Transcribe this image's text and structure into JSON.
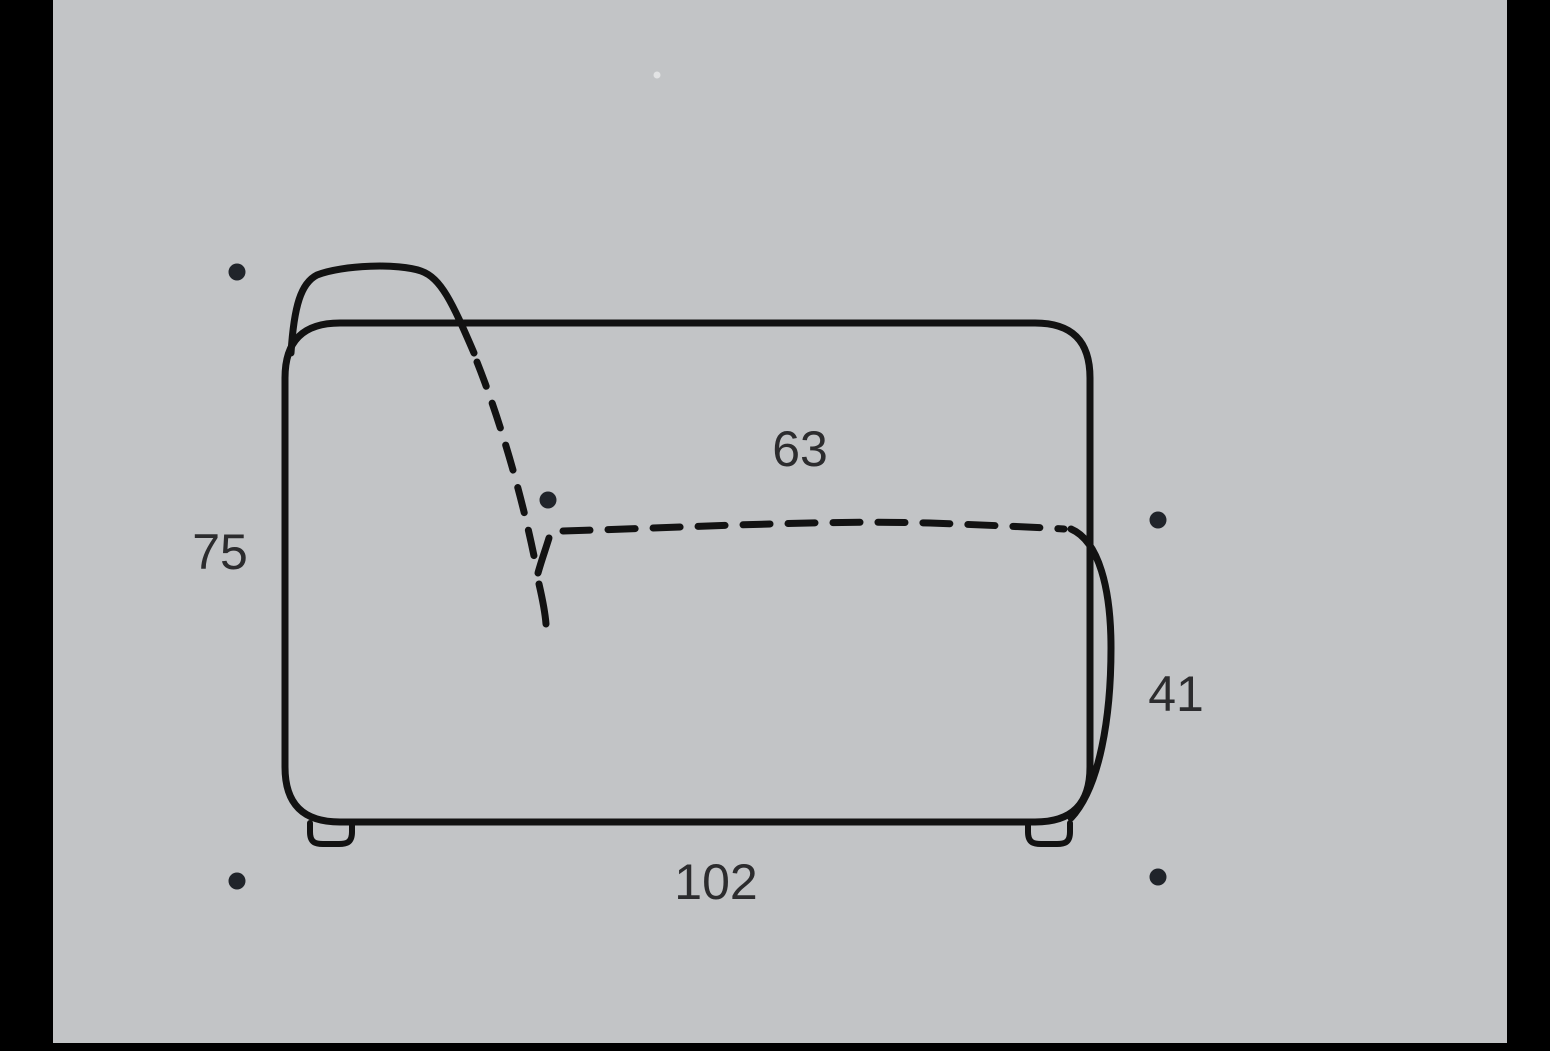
{
  "diagram": {
    "title": "sofa-module-side-view-dimension-drawing",
    "units_shown": false,
    "dimensions": {
      "overall_height": {
        "value": "75",
        "position": "left"
      },
      "seat_depth": {
        "value": "63",
        "position": "above-seat-dashed-line"
      },
      "seat_height": {
        "value": "41",
        "position": "right"
      },
      "overall_depth": {
        "value": "102",
        "position": "bottom"
      }
    },
    "markers": {
      "count": 5,
      "description": "small round reference dots at top-left, mid-seat junction, right, bottom-left, bottom-right"
    }
  },
  "colors": {
    "background": "#c2c4c6",
    "frame": "#000000",
    "line": "#121212",
    "marker_dot": "#20242a",
    "label_text": "#2c2c2e"
  }
}
